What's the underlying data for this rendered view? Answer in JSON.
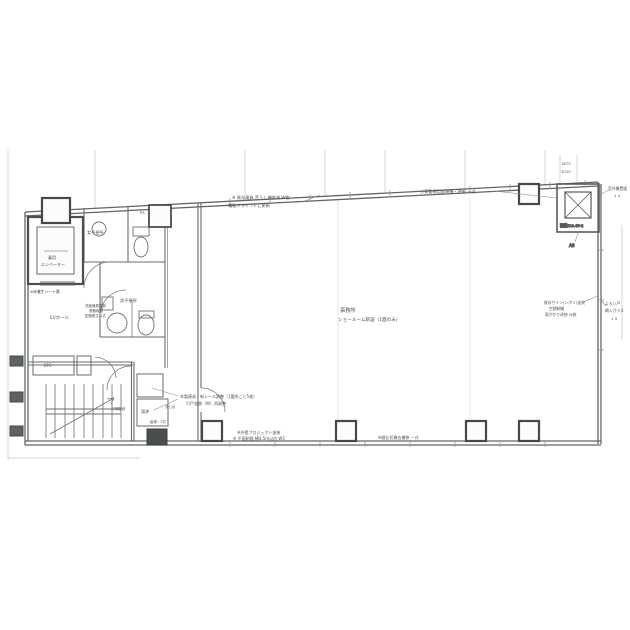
{
  "colors": {
    "paper": "#fcfcfa",
    "line": "#6b706e",
    "dark": "#45494b",
    "faint": "#c6c9c6"
  },
  "rooms": {
    "office": {
      "name": "事務所",
      "note": "ショールーム新設（1面のみ）"
    },
    "ev_hall": {
      "name": "EVホール"
    },
    "womens_toilet": {
      "name": "女子便所"
    },
    "mens_toilet": {
      "name": "男子便所"
    },
    "stair": {
      "name": "非常階段"
    },
    "kitchenette": {
      "name": "湯沸"
    },
    "eps": {
      "name": "EPS"
    },
    "ps": {
      "name": "PS"
    },
    "elevator": {
      "line1": "乗用",
      "line2": "エレベーター",
      "note": "※床養生シート敷"
    },
    "dumbwaiter": {
      "cap": "積載/16.45·2",
      "grid": "A8"
    }
  },
  "notes": {
    "top_1": "※ 既存建具 荒らし補修済 W枚",
    "top_2": "電動ブラインドに更新",
    "dumbwaiter": "小荷物専用昇降機・更新 一式",
    "right_in_1": "既存サイン(シボリ)塗装",
    "right_in_2": "空調制御",
    "right_in_3": "雨がかり改修 W枚",
    "right_out_1": "よろい戸",
    "right_out_2": "網入ガラス",
    "right_out_3": "1 4",
    "outdoor_1": "室外機置場",
    "outdoor_2": "1 4",
    "wash_1": "洗面器具更新",
    "wash_2": "便器取替",
    "wash_3": "配管更生 1式",
    "doors_1": "木製建具・新レール調整（1箇所ごと5枚）",
    "doors_2": "引戸金物（W）再調整",
    "kitchen_1": "流し台",
    "kitchen_2": "給湯・1式",
    "bottom_a1": "※外壁プロジェクト塗装",
    "bottom_a2": "※ 平面制限 横4.5m以内 W5",
    "bottom_b": "※間仕切撤去補修 一式"
  },
  "dims": {
    "rt_1": "1675",
    "rt_2": "2010"
  }
}
